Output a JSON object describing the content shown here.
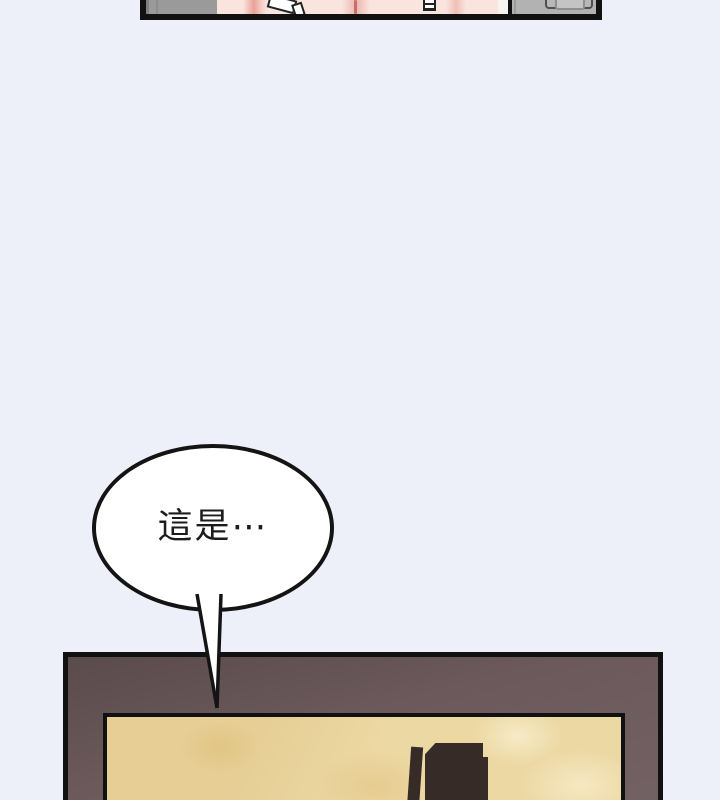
{
  "page": {
    "background_color": "#edf0f8"
  },
  "top_panel": {
    "border_color": "#111111",
    "wall_left_color": "#9a9a9a",
    "wall_right_color": "#b2b2b2",
    "skin_color": "#f9e5dd",
    "skin_highlight_color": "#f7f3f1",
    "divider_color": "#111111",
    "strap_color": "#ffffff",
    "handle_fill_color": "#b8b8b8",
    "handle_inner_color": "#c4c4c4"
  },
  "speech_bubble": {
    "text": "這是⋯",
    "fill_color": "#ffffff",
    "outline_color": "#141414",
    "text_color": "#1c1c1c"
  },
  "bottom_panel": {
    "border_color": "#111111",
    "frame_color": "#6b595b",
    "inner_border_color": "#111111",
    "surface_color": "#ecd8a3",
    "object_color": "#362b27"
  }
}
